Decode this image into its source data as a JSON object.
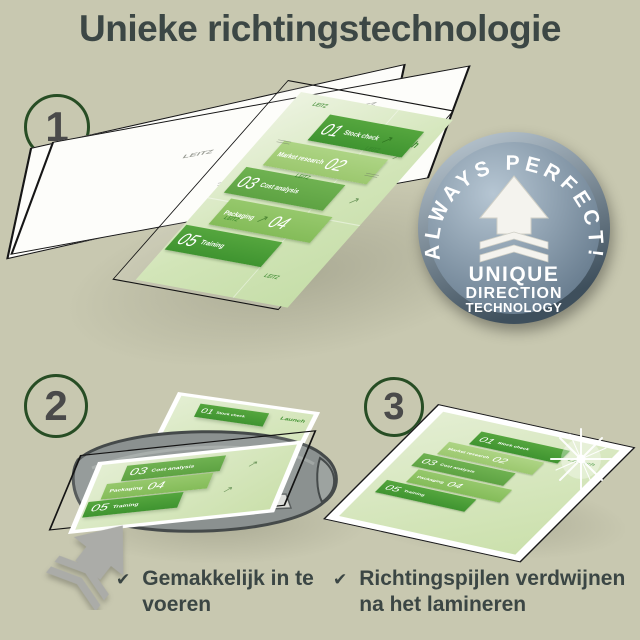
{
  "title": "Unieke richtingstechnologie",
  "steps": [
    {
      "number": "1"
    },
    {
      "number": "2"
    },
    {
      "number": "3"
    }
  ],
  "badge": {
    "arc_text": "ALWAYS PERFECT!",
    "line1": "UNIQUE",
    "line2": "DIRECTION",
    "line3": "TECHNOLOGY"
  },
  "document": {
    "launch_label": "Launch",
    "watermark": "LEITZ",
    "bands": [
      {
        "num": "01",
        "label": "Stock check"
      },
      {
        "num": "02",
        "label": "Market research"
      },
      {
        "num": "03",
        "label": "Cost analysis"
      },
      {
        "num": "04",
        "label": "Packaging"
      },
      {
        "num": "05",
        "label": "Training"
      }
    ]
  },
  "captions": [
    {
      "check": "✔",
      "text": "Gemakkelijk in te voeren"
    },
    {
      "check": "✔",
      "text": "Richtingspijlen verdwijnen na het lamineren"
    }
  ],
  "icons": {
    "check": "✔",
    "direction_arrow": "↗"
  },
  "colors": {
    "background": "#c8c8b0",
    "title": "#3c4745",
    "circle_border": "#274d24",
    "band_dark": "#459a33",
    "band_mid": "#67ad4a",
    "band_mid2": "#8cc263",
    "band_light": "#a4cd79",
    "doc_background": "#d6e7c0",
    "badge_face": "#5d7285",
    "badge_text": "#ffffff",
    "laminator_gray": "#8b9190",
    "arrow_gray": "#abaca8"
  }
}
